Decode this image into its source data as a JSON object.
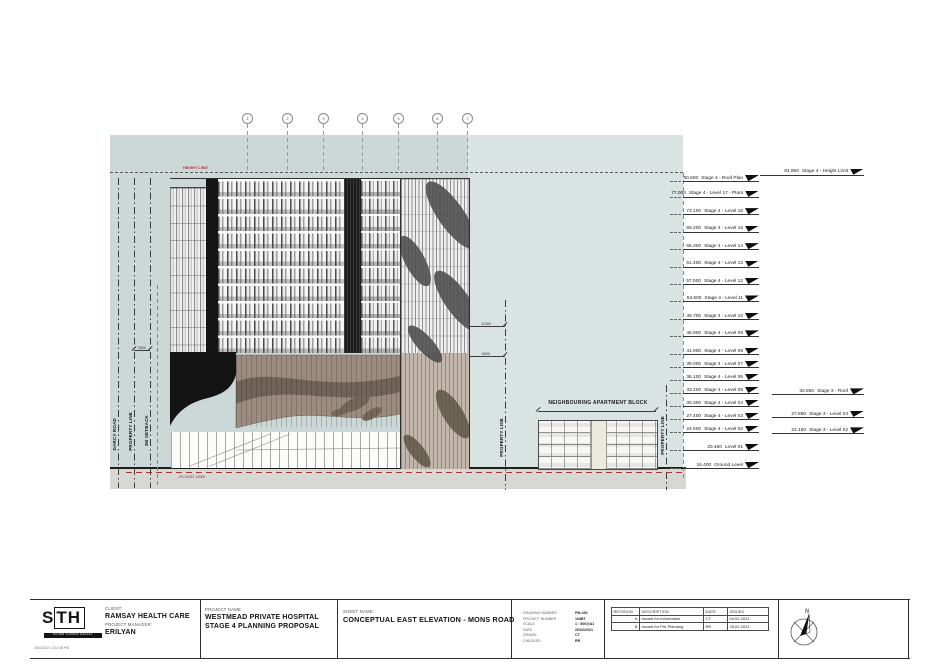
{
  "drawing": {
    "height_limit_label": "HEIGHT LIMIT",
    "flood_line_label": "-FLOOD LINE",
    "site_labels": [
      "DARCY ROAD",
      "PROPERTY LINE",
      "3M SETBACK"
    ],
    "property_line_mid_label": "PROPERTY LINE",
    "property_line_right_label": "PROPERTY LINE",
    "neighbour_label": "NEIGHBOURING APARTMENT BLOCK",
    "dim_upper": "11000",
    "dim_lower": "6000",
    "dim_setback": "3000",
    "grid_bubbles": [
      "1",
      "2",
      "3",
      "4",
      "5",
      "6",
      "7"
    ],
    "levels_stage4": [
      {
        "value": "80.500",
        "name": "Stage 4 - Roof Plan",
        "elev": 80.5
      },
      {
        "value": "77.000",
        "name": "Stage 4 - Level 17 - Plant",
        "elev": 77.0
      },
      {
        "value": "73.100",
        "name": "Stage 4 - Level 16",
        "elev": 73.1
      },
      {
        "value": "69.200",
        "name": "Stage 4 - Level 15",
        "elev": 69.2
      },
      {
        "value": "65.300",
        "name": "Stage 4 - Level 14",
        "elev": 65.3
      },
      {
        "value": "61.400",
        "name": "Stage 4 - Level 13",
        "elev": 61.4
      },
      {
        "value": "57.500",
        "name": "Stage 4 - Level 12",
        "elev": 57.5
      },
      {
        "value": "53.600",
        "name": "Stage 4 - Level 11",
        "elev": 53.6
      },
      {
        "value": "49.700",
        "name": "Stage 4 - Level 10",
        "elev": 49.7
      },
      {
        "value": "45.800",
        "name": "Stage 4 - Level 09",
        "elev": 45.8
      },
      {
        "value": "41.900",
        "name": "Stage 4 - Level 08",
        "elev": 41.9
      },
      {
        "value": "39.000",
        "name": "Stage 4 - Level 07",
        "elev": 39.0
      },
      {
        "value": "36.100",
        "name": "Stage 4 - Level 06",
        "elev": 36.1
      },
      {
        "value": "33.200",
        "name": "Stage 4 - Level 05",
        "elev": 33.2
      },
      {
        "value": "30.300",
        "name": "Stage 4 - Level 04",
        "elev": 30.3
      },
      {
        "value": "27.400",
        "name": "Stage 4 - Level 03",
        "elev": 27.4
      },
      {
        "value": "24.500",
        "name": "Stage 4 - Level 02",
        "elev": 24.5
      },
      {
        "value": "20.450",
        "name": "Level 01",
        "elev": 20.45
      },
      {
        "value": "16.400",
        "name": "Ground Level",
        "elev": 16.4
      }
    ],
    "levels_stage3": [
      {
        "value": "81.950",
        "name": "Stage 4 - Height Limit",
        "elev": 81.95
      },
      {
        "value": "32.850",
        "name": "Stage 3 - Roof",
        "elev": 32.85
      },
      {
        "value": "27.850",
        "name": "Stage 3 - Level 03",
        "elev": 27.85
      },
      {
        "value": "24.150",
        "name": "Stage 3 - Level 02",
        "elev": 24.15
      }
    ]
  },
  "titleblock": {
    "logo_text": "STH",
    "logo_sub": "SILVER THOMAS HANLEY",
    "print_date": "26/02/2021 3:11:38 PM",
    "client_label": "CLIENT:",
    "client": "RAMSAY HEALTH CARE",
    "pm_label": "PROJECT MANAGER:",
    "pm": "ERILYAN",
    "project_label": "PROJECT NAME:",
    "project_line1": "WESTMEAD PRIVATE HOSPITAL",
    "project_line2": "STAGE 4 PLANNING PROPOSAL",
    "sheet_label": "SHEET NAME:",
    "sheet": "CONCEPTUAL EAST ELEVATION - MONS ROAD",
    "info": [
      {
        "label": "DRAWING NUMBER",
        "value": "PM-452"
      },
      {
        "label": "PROJECT NUMBER",
        "value": "194BT"
      },
      {
        "label": "SCALE",
        "value": "1 : 500@A1"
      },
      {
        "label": "DATE",
        "value": "26/02/2021"
      },
      {
        "label": "DRAWN",
        "value": "CT"
      },
      {
        "label": "CHECKED",
        "value": "RR"
      }
    ],
    "revisions": {
      "headers": [
        "REVISION",
        "DESCRIPTION",
        "DATE",
        "ISSUED"
      ],
      "rows": [
        {
          "rev": "A",
          "desc": "Issued for Information",
          "date": "CT",
          "issued": "04.02.2021"
        },
        {
          "rev": "B",
          "desc": "Issued for Pre-Planning",
          "date": "RR",
          "issued": "25.02.2021"
        }
      ]
    },
    "north_label": "N"
  },
  "colors": {
    "sky": "#ccd8d7",
    "earth": "#d7d7d4",
    "flood_red": "#b03434",
    "podium_brown": "#9c8c7f",
    "podium_wave": "#6e6156",
    "leaf_dark": "#4d4d4d",
    "black_band": "#151515"
  }
}
